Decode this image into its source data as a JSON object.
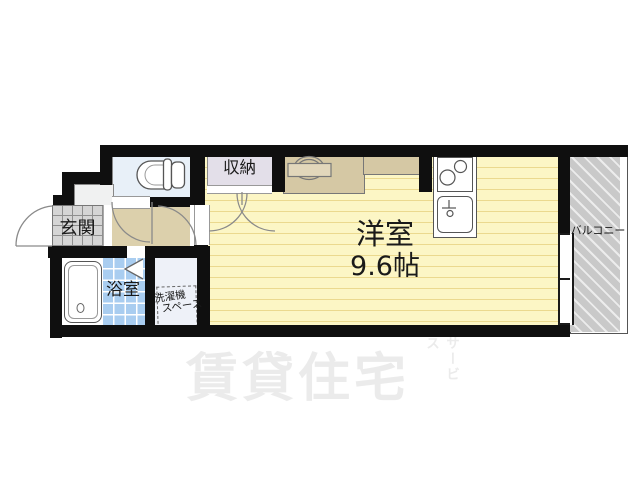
{
  "floorplan": {
    "rooms": {
      "entrance": {
        "label": "玄関"
      },
      "bathroom": {
        "label": "浴室"
      },
      "laundry_space": {
        "line1": "洗濯機",
        "line2": "スペース"
      },
      "closet": {
        "label": "収納"
      },
      "main_room": {
        "name": "洋室",
        "size": "9.6帖"
      },
      "balcony": {
        "label": "バルコニー"
      }
    },
    "fixtures": [
      "toilet",
      "bathtub",
      "range",
      "two-burner-stove",
      "kitchen-sink",
      "washing-machine-space",
      "door-swings",
      "folding-door",
      "window"
    ],
    "watermark": {
      "main": "賃貸住宅",
      "sub": "サービス"
    },
    "colors": {
      "wall": "#0f0f0f",
      "room_floor": "#fcf6c5",
      "room_stripe": "#ebd98e",
      "hall_floor": "#dcd0ac",
      "counter": "#d5c8a4",
      "closet_floor": "#e3dfe9",
      "toilet_floor": "#e8f0f8",
      "bath_tile": "#a9cdf0",
      "entrance_tile": "#d5d5d5",
      "laundry_floor": "#eef1f8",
      "balcony": "#c9c9c9",
      "watermark": "#ebebeb"
    }
  }
}
